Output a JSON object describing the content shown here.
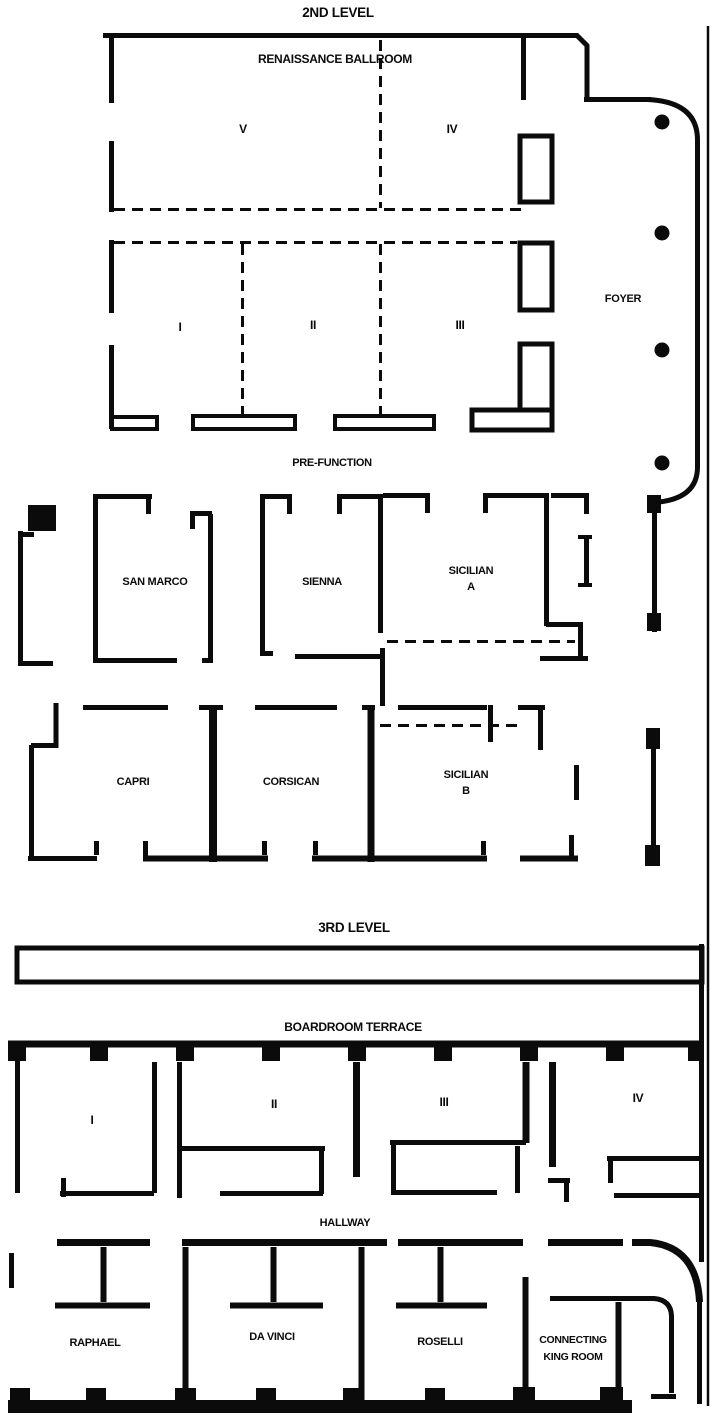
{
  "level2": {
    "title": "2ND LEVEL",
    "ballroom": {
      "name": "RENAISSANCE BALLROOM",
      "sections": {
        "v": "V",
        "iv": "IV",
        "i": "I",
        "ii": "II",
        "iii": "III"
      }
    },
    "foyer_label": "FOYER",
    "prefunction_label": "PRE-FUNCTION",
    "rooms": {
      "san_marco": "SAN MARCO",
      "sienna": "SIENNA",
      "sicilian_a_line1": "SICILIAN",
      "sicilian_a_line2": "A",
      "capri": "CAPRI",
      "corsican": "CORSICAN",
      "sicilian_b_line1": "SICILIAN",
      "sicilian_b_line2": "B"
    }
  },
  "level3": {
    "title": "3RD LEVEL",
    "terrace_label": "BOARDROOM TERRACE",
    "sections": {
      "i": "I",
      "ii": "II",
      "iii": "III",
      "iv": "IV"
    },
    "hallway_label": "HALLWAY",
    "rooms": {
      "raphael": "RAPHAEL",
      "da_vinci": "DA VINCI",
      "roselli": "ROSELLI",
      "king_line1": "CONNECTING",
      "king_line2": "KING ROOM"
    }
  },
  "colors": {
    "ink": "#0b0b0b",
    "background": "#ffffff"
  }
}
